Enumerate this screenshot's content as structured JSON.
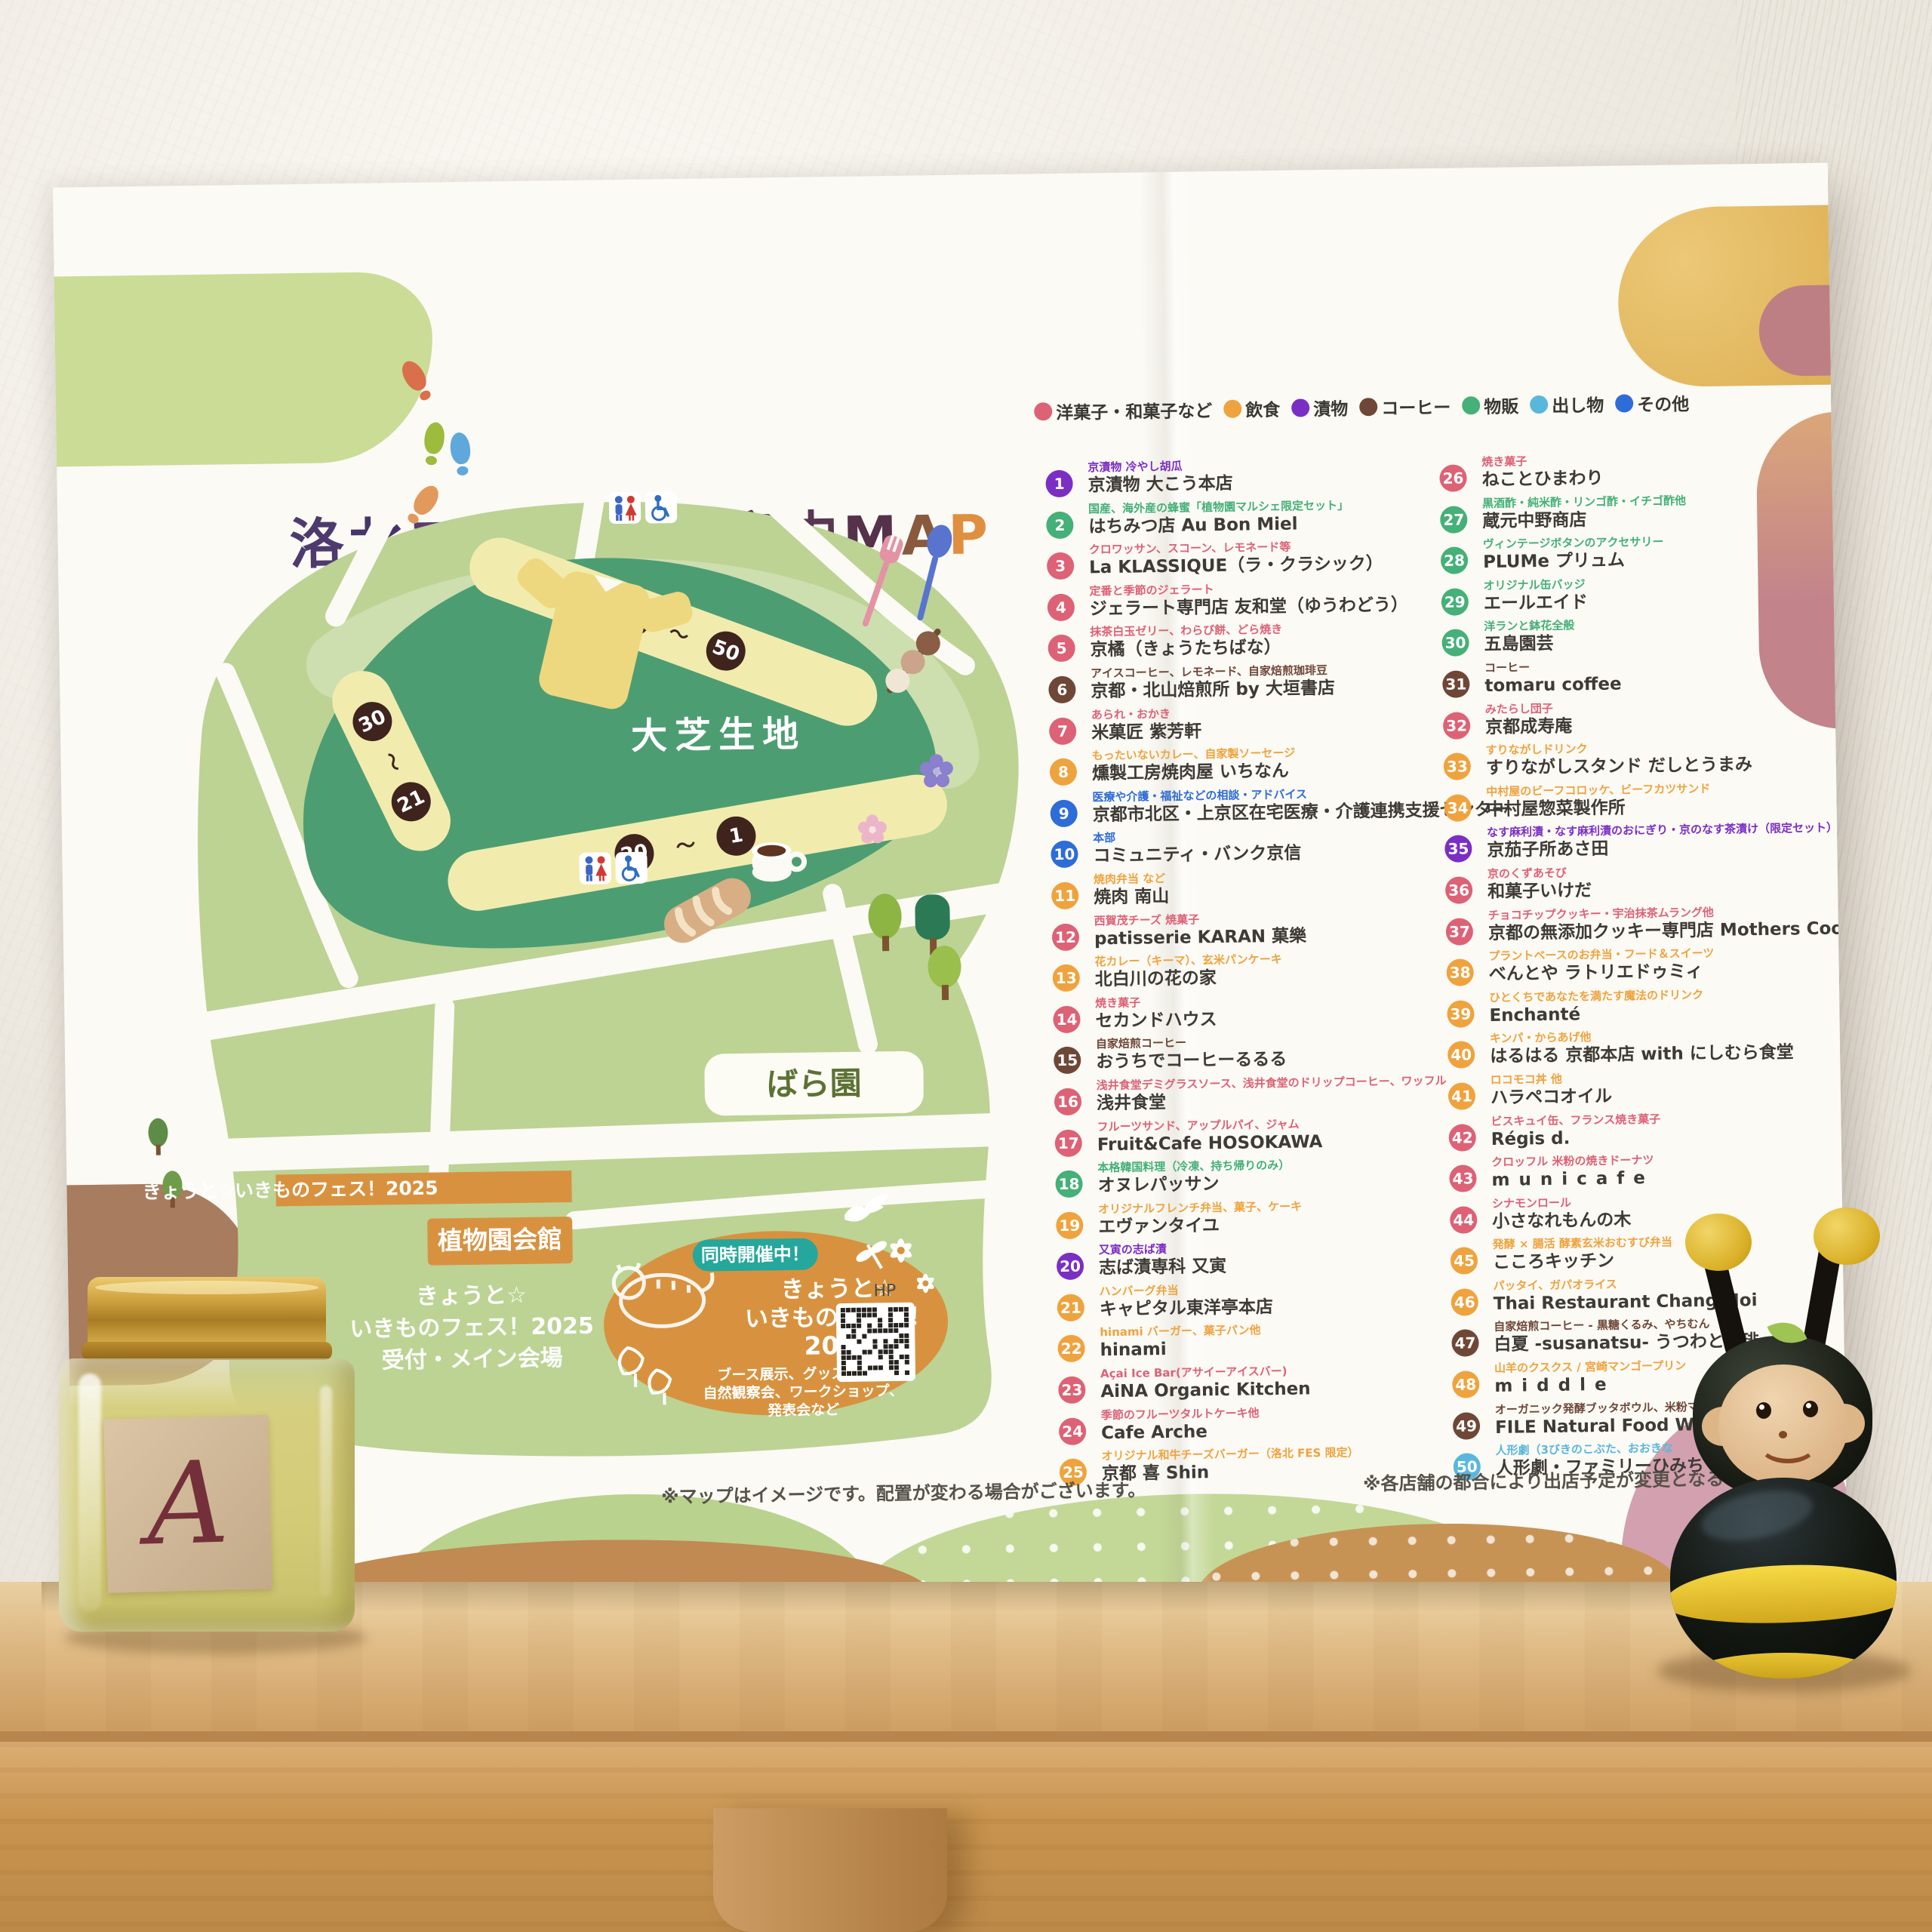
{
  "title": {
    "chars": [
      {
        "ch": "洛",
        "color": "#4e3a6d"
      },
      {
        "ch": "北",
        "color": "#45366a"
      },
      {
        "ch": "フ",
        "color": "#5e3c6f"
      },
      {
        "ch": "ェ",
        "color": "#4b3f74"
      },
      {
        "ch": "ス",
        "color": "#573a6b"
      },
      {
        "ch": " ",
        "color": "#000000"
      },
      {
        "ch": "会",
        "color": "#5e3a55"
      },
      {
        "ch": "場",
        "color": "#5e3a55"
      },
      {
        "ch": "案",
        "color": "#593652"
      },
      {
        "ch": "内",
        "color": "#593652"
      },
      {
        "ch": "M",
        "color": "#55324a"
      },
      {
        "ch": "A",
        "color": "#8a5a3e"
      },
      {
        "ch": "P",
        "color": "#df8f3f"
      }
    ]
  },
  "legend": [
    {
      "label": "洋菓子・和菓子など",
      "color": "#dd6276"
    },
    {
      "label": "飲食",
      "color": "#efa33e"
    },
    {
      "label": "漬物",
      "color": "#7b2ec4"
    },
    {
      "label": "コーヒー",
      "color": "#6f4737"
    },
    {
      "label": "物販",
      "color": "#45b077"
    },
    {
      "label": "出し物",
      "color": "#5ab7dc"
    },
    {
      "label": "その他",
      "color": "#2e6cd8"
    }
  ],
  "categories": {
    "wagashi": {
      "label": "洋菓子・和菓子など",
      "color": "#dd6276"
    },
    "food": {
      "label": "飲食",
      "color": "#efa33e"
    },
    "pickles": {
      "label": "漬物",
      "color": "#7b2ec4"
    },
    "coffee": {
      "label": "コーヒー",
      "color": "#6f4737"
    },
    "goods": {
      "label": "物販",
      "color": "#45b077"
    },
    "stage": {
      "label": "出し物",
      "color": "#5ab7dc"
    },
    "other": {
      "label": "その他",
      "color": "#2e6cd8"
    }
  },
  "map": {
    "lawn": "大芝生地",
    "rose": "ばら園",
    "hall": "植物園会館",
    "banner": "きょうと☆いきものフェス！2025",
    "reception": [
      "きょうと☆",
      "いきものフェス！2025",
      "受付・メイン会場"
    ],
    "event": {
      "badge": "同時開催中！",
      "lines": [
        "きょうと☆",
        "いきものフェス！",
        "2025"
      ],
      "desc": [
        "ブース展示、グッズ販売、",
        "自然観察会、ワークショップ、",
        "発表会など"
      ],
      "hp": "HP"
    },
    "ranges": {
      "top": [
        "31",
        "50"
      ],
      "left": [
        "30",
        "21"
      ],
      "bottom": [
        "20",
        "1"
      ]
    },
    "tilde": "〜"
  },
  "notes": {
    "left": "※マップはイメージです。配置が変わる場合がございます。",
    "right": "※各店舗の都合により出店予定が変更となる場合があ"
  },
  "stalls": {
    "left": [
      {
        "n": "1",
        "cat": "pickles",
        "desc": "京漬物 冷やし胡瓜",
        "name": "京漬物 大こう本店"
      },
      {
        "n": "2",
        "cat": "goods",
        "desc": "国産、海外産の蜂蜜「植物園マルシェ限定セット」",
        "name": "はちみつ店 Au Bon Miel"
      },
      {
        "n": "3",
        "cat": "wagashi",
        "desc": "クロワッサン、スコーン、レモネード等",
        "name": "La KLASSIQUE（ラ・クラシック）"
      },
      {
        "n": "4",
        "cat": "wagashi",
        "desc": "定番と季節のジェラート",
        "name": "ジェラート専門店 友和堂（ゆうわどう）"
      },
      {
        "n": "5",
        "cat": "wagashi",
        "desc": "抹茶白玉ゼリー、わらび餅、どら焼き",
        "name": "京橘（きょうたちばな）"
      },
      {
        "n": "6",
        "cat": "coffee",
        "desc": "アイスコーヒー、レモネード、自家焙煎珈琲豆",
        "name": "京都・北山焙煎所 by 大垣書店"
      },
      {
        "n": "7",
        "cat": "wagashi",
        "desc": "あられ・おかき",
        "name": "米菓匠 紫芳軒"
      },
      {
        "n": "8",
        "cat": "food",
        "desc": "もったいないカレー、自家製ソーセージ",
        "name": "燻製工房焼肉屋 いちなん"
      },
      {
        "n": "9",
        "cat": "other",
        "desc": "医療や介護・福祉などの相談・アドバイス",
        "name": "京都市北区・上京区在宅医療・介護連携支援センター"
      },
      {
        "n": "10",
        "cat": "other",
        "desc": "本部",
        "name": "コミュニティ・バンク京信"
      },
      {
        "n": "11",
        "cat": "food",
        "desc": "焼肉弁当 など",
        "name": "焼肉 南山"
      },
      {
        "n": "12",
        "cat": "wagashi",
        "desc": "西賀茂チーズ 焼菓子",
        "name": "patisserie KARAN 菓樂"
      },
      {
        "n": "13",
        "cat": "food",
        "desc": "花カレー（キーマ）、玄米パンケーキ",
        "name": "北白川の花の家"
      },
      {
        "n": "14",
        "cat": "wagashi",
        "desc": "焼き菓子",
        "name": "セカンドハウス"
      },
      {
        "n": "15",
        "cat": "coffee",
        "desc": "自家焙煎コーヒー",
        "name": "おうちでコーヒーるるる"
      },
      {
        "n": "16",
        "cat": "wagashi",
        "desc": "浅井食堂デミグラスソース、浅井食堂のドリップコーヒー、ワッフル",
        "name": "浅井食堂"
      },
      {
        "n": "17",
        "cat": "wagashi",
        "desc": "フルーツサンド、アップルパイ、ジャム",
        "name": "Fruit&Cafe HOSOKAWA"
      },
      {
        "n": "18",
        "cat": "goods",
        "desc": "本格韓国料理（冷凍、持ち帰りのみ）",
        "name": "オヌレパッサン"
      },
      {
        "n": "19",
        "cat": "food",
        "desc": "オリジナルフレンチ弁当、菓子、ケーキ",
        "name": "エヴァンタイユ"
      },
      {
        "n": "20",
        "cat": "pickles",
        "desc": "又寅の志ば漬",
        "name": "志ば漬専科 又寅"
      },
      {
        "n": "21",
        "cat": "food",
        "desc": "ハンバーグ弁当",
        "name": "キャピタル東洋亭本店"
      },
      {
        "n": "22",
        "cat": "food",
        "desc": "hinami バーガー、菓子パン他",
        "name": "hinami"
      },
      {
        "n": "23",
        "cat": "wagashi",
        "desc": "Açai Ice Bar(アサイーアイスバー)",
        "name": "AiNA Organic Kitchen"
      },
      {
        "n": "24",
        "cat": "wagashi",
        "desc": "季節のフルーツタルトケーキ他",
        "name": "Cafe Arche"
      },
      {
        "n": "25",
        "cat": "food",
        "desc": "オリジナル和牛チーズバーガー（洛北 FES 限定）",
        "name": "京都 喜 Shin"
      }
    ],
    "right": [
      {
        "n": "26",
        "cat": "wagashi",
        "desc": "焼き菓子",
        "name": "ねことひまわり"
      },
      {
        "n": "27",
        "cat": "goods",
        "desc": "黒酒酢・純米酢・リンゴ酢・イチゴ酢他",
        "name": "蔵元中野商店"
      },
      {
        "n": "28",
        "cat": "goods",
        "desc": "ヴィンテージボタンのアクセサリー",
        "name": "PLUMe プリュム"
      },
      {
        "n": "29",
        "cat": "goods",
        "desc": "オリジナル缶バッジ",
        "name": "エールエイド"
      },
      {
        "n": "30",
        "cat": "goods",
        "desc": "洋ランと鉢花全般",
        "name": "五島園芸"
      },
      {
        "n": "31",
        "cat": "coffee",
        "desc": "コーヒー",
        "name": "tomaru coffee"
      },
      {
        "n": "32",
        "cat": "wagashi",
        "desc": "みたらし団子",
        "name": "京都成寿庵"
      },
      {
        "n": "33",
        "cat": "food",
        "desc": "すりながしドリンク",
        "name": "すりながしスタンド だしとうまみ"
      },
      {
        "n": "34",
        "cat": "food",
        "desc": "中村屋のビーフコロッケ、ビーフカツサンド",
        "name": "中村屋惣菜製作所"
      },
      {
        "n": "35",
        "cat": "pickles",
        "desc": "なす麻利漬・なす麻利漬のおにぎり・京のなす茶漬け（限定セット）",
        "name": "京茄子所あさ田"
      },
      {
        "n": "36",
        "cat": "wagashi",
        "desc": "京のくずあそび",
        "name": "和菓子いけだ"
      },
      {
        "n": "37",
        "cat": "wagashi",
        "desc": "チョコチップクッキー・宇治抹茶ムラング他",
        "name": "京都の無添加クッキー専門店 Mothers Cookie"
      },
      {
        "n": "38",
        "cat": "food",
        "desc": "プラントベースのお弁当・フード＆スイーツ",
        "name": "べんとや ラトリエドゥミィ"
      },
      {
        "n": "39",
        "cat": "food",
        "desc": "ひとくちであなたを満たす魔法のドリンク",
        "name": "Enchanté"
      },
      {
        "n": "40",
        "cat": "food",
        "desc": "キンパ・からあげ他",
        "name": "はるはる 京都本店 with にしむら食堂"
      },
      {
        "n": "41",
        "cat": "food",
        "desc": "ロコモコ丼 他",
        "name": "ハラペコオイル"
      },
      {
        "n": "42",
        "cat": "wagashi",
        "desc": "ビスキュイ缶、フランス焼き菓子",
        "name": "Régis d."
      },
      {
        "n": "43",
        "cat": "wagashi",
        "desc": "クロッフル 米粉の焼きドーナツ",
        "name": "municafe",
        "spaced": true
      },
      {
        "n": "44",
        "cat": "wagashi",
        "desc": "シナモンロール",
        "name": "小さなれもんの木"
      },
      {
        "n": "45",
        "cat": "food",
        "desc": "発酵 × 腸活 酵素玄米おむすび弁当",
        "name": "こころキッチン"
      },
      {
        "n": "46",
        "cat": "food",
        "desc": "パッタイ、ガパオライス",
        "name": "Thai Restaurant Chang-Noi"
      },
      {
        "n": "47",
        "cat": "coffee",
        "desc": "自家焙煎コーヒー - 黒糖くるみ、やちむん",
        "name": "白夏 -susanatsu- うつわと珈琲"
      },
      {
        "n": "48",
        "cat": "food",
        "desc": "山羊のクスクス / 宮崎マンゴープリン",
        "name": "middle",
        "spaced": true
      },
      {
        "n": "49",
        "cat": "coffee",
        "desc": "オーガニック発酵ブッタボウル、米粉マフィン、オ",
        "name": "FILE Natural Food Works"
      },
      {
        "n": "50",
        "cat": "stage",
        "desc": "人形劇（3びきのこぶた、おおきな",
        "name": "人形劇・ファミリーひみち"
      }
    ]
  },
  "foreground": {
    "jar_label": "A"
  }
}
